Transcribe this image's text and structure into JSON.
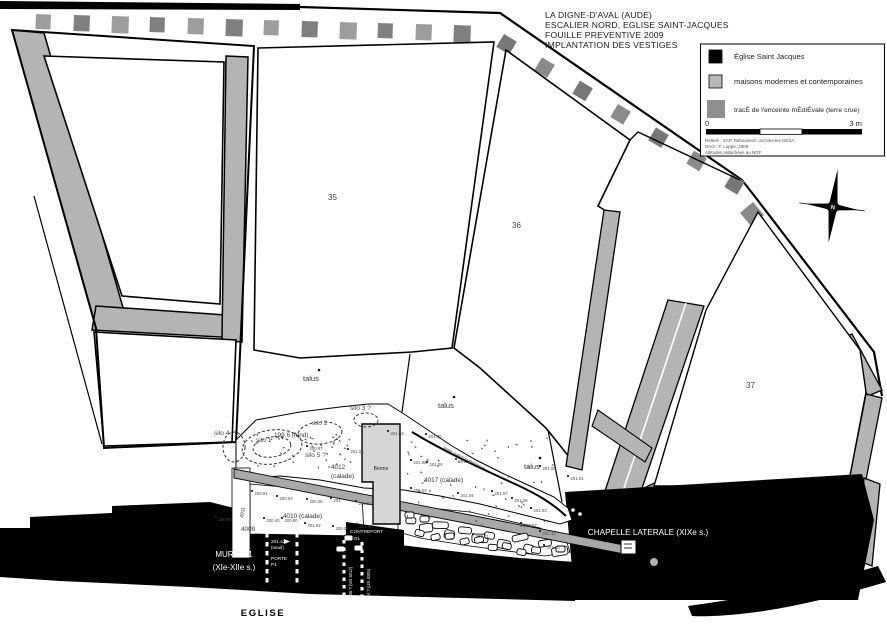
{
  "title_block": {
    "lines": [
      "LA DIGNE-D'AVAL (AUDE)",
      "ESCALIER NORD, EGLISE SAINT-JACQUES",
      "FOUILLE PREVENTIVE 2009",
      "IMPLANTATION DES VESTIGES"
    ]
  },
  "legend": {
    "items": [
      {
        "label": "Église Saint Jacques",
        "swatch": "#000000"
      },
      {
        "label": "maisons modernes et contemporaines",
        "swatch": "#b9b9b9"
      },
      {
        "label": "tracÉ de l'enceinte mÉdiÉvale (terre crue)",
        "swatch": "#8f8f8f"
      }
    ],
    "scale": {
      "start": "0",
      "end": "3 m"
    },
    "credits": [
      "Relevé : SCP Tarbouriech, architectes DESA",
      "DAO : F. Loppe, 2009",
      "Altitudes rattachées au NGF"
    ]
  },
  "compass": {
    "letter": "N"
  },
  "parcels": [
    {
      "text": "35",
      "x": 328,
      "y": 200
    },
    {
      "text": "36",
      "x": 512,
      "y": 228
    },
    {
      "text": "37",
      "x": 746,
      "y": 388
    }
  ],
  "talus": [
    {
      "text": "talus",
      "x": 303,
      "y": 381
    },
    {
      "text": "talus",
      "x": 438,
      "y": 408
    },
    {
      "text": "talus",
      "x": 524,
      "y": 469
    }
  ],
  "silos": [
    {
      "text": "silo 4",
      "x": 214,
      "y": 435
    },
    {
      "text": "silo 1",
      "x": 256,
      "y": 442
    },
    {
      "text": "silo 2",
      "x": 312,
      "y": 425
    },
    {
      "text": "silo 3 ?",
      "x": 350,
      "y": 410
    },
    {
      "text": "silo 5 ?",
      "x": 305,
      "y": 457
    }
  ],
  "areas": [
    {
      "text": "4012",
      "x": 331,
      "y": 469
    },
    {
      "text": "(calade)",
      "x": 331,
      "y": 478
    },
    {
      "text": "4010 (calade)",
      "x": 283,
      "y": 518
    },
    {
      "text": "4017 (calade)",
      "x": 424,
      "y": 482
    },
    {
      "text": "4009",
      "x": 241,
      "y": 531
    },
    {
      "text": "199.6 (fond)",
      "x": 274,
      "y": 437
    }
  ],
  "berme_label": "Berme",
  "rotated_labels": {
    "limite": "limite substrat conservé",
    "us_a": "4036 ? (US 4012)",
    "us_b": "4034 ? (US 4005)",
    "wall_id": "4011"
  },
  "structures": {
    "mur_line1": "MUR MR1",
    "mur_line2": "(XIe-XIIe s.)",
    "eglise": "EGLISE",
    "chapelle": "CHAPELLE LATERALE (XIXe s.)",
    "contrefort_line1": "CONTREFORT",
    "contrefort_line2": "CO1",
    "porte_alt": "201.42",
    "porte_seuil": "(seuil)",
    "porte_line1": "PORTE",
    "porte_line2": "P1"
  },
  "spot_elevations": [
    {
      "v": "200.97",
      "x": 216,
      "y": 521
    },
    {
      "v": "200.91",
      "x": 252,
      "y": 495
    },
    {
      "v": "200.02",
      "x": 277,
      "y": 500
    },
    {
      "v": "200.06",
      "x": 307,
      "y": 503
    },
    {
      "v": "201",
      "x": 331,
      "y": 502
    },
    {
      "v": "201.54",
      "x": 356,
      "y": 505
    },
    {
      "v": "200.40",
      "x": 264,
      "y": 522
    },
    {
      "v": "200.80",
      "x": 282,
      "y": 522
    },
    {
      "v": "201.02",
      "x": 305,
      "y": 527
    },
    {
      "v": "200.06",
      "x": 333,
      "y": 530
    },
    {
      "v": "201.06",
      "x": 357,
      "y": 528
    },
    {
      "v": "200.97",
      "x": 307,
      "y": 450
    },
    {
      "v": "201.05",
      "x": 348,
      "y": 453
    },
    {
      "v": "201.03",
      "x": 388,
      "y": 435
    },
    {
      "v": "201.05",
      "x": 426,
      "y": 438
    },
    {
      "v": "201.08",
      "x": 411,
      "y": 464
    },
    {
      "v": "201.09",
      "x": 427,
      "y": 466
    },
    {
      "v": "201.04",
      "x": 411,
      "y": 492
    },
    {
      "v": "201.10",
      "x": 456,
      "y": 463
    },
    {
      "v": "201.57",
      "x": 492,
      "y": 495
    },
    {
      "v": "201.04",
      "x": 458,
      "y": 497
    },
    {
      "v": "201.08",
      "x": 512,
      "y": 502
    },
    {
      "v": "201.03",
      "x": 531,
      "y": 512
    },
    {
      "v": "201.07",
      "x": 521,
      "y": 527
    },
    {
      "v": "201.13",
      "x": 540,
      "y": 535
    },
    {
      "v": "201.01",
      "x": 473,
      "y": 538
    },
    {
      "v": "201.16",
      "x": 544,
      "y": 549
    },
    {
      "v": "201.09",
      "x": 540,
      "y": 470
    },
    {
      "v": "201.01",
      "x": 568,
      "y": 480
    }
  ]
}
